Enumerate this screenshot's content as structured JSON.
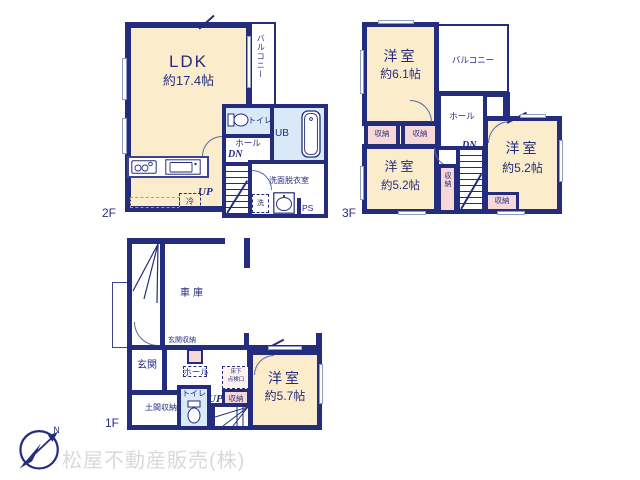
{
  "watermark": "松屋不動産販売(株)",
  "compass": {
    "north_label": "N"
  },
  "floor_labels": {
    "f1": "1F",
    "f2": "2F",
    "f3": "3F"
  },
  "terms": {
    "balcony": "バルコニー",
    "hall": "ホール",
    "toilet": "トイレ",
    "closet": "収納",
    "dn": "DN",
    "up": "UP",
    "unit_bath": "UB",
    "washroom": "洗面脱衣室",
    "washer": "洗",
    "pipe_space": "PS",
    "fridge": "冷",
    "garage": "車庫",
    "entrance": "玄関",
    "entrance_storage": "玄関収納",
    "doma_storage": "土間収納",
    "underfloor_hatch_line1": "床下",
    "underfloor_hatch_line2": "点検口"
  },
  "rooms": {
    "ldk": {
      "name": "LDK",
      "size": "約17.4帖"
    },
    "f3_room_61": {
      "name": "洋室",
      "size": "約6.1帖"
    },
    "f3_room_52_left": {
      "name": "洋室",
      "size": "約5.2帖"
    },
    "f3_room_52_right": {
      "name": "洋室",
      "size": "約5.2帖"
    },
    "f1_room_57": {
      "name": "洋室",
      "size": "約5.7帖"
    }
  },
  "colors": {
    "wall": "#242d7d",
    "room_cream": "#fbeccb",
    "closet_pink": "#f8d8d7",
    "wet_blue": "#d9e9f8",
    "watermark_gray": "#d9d9d9"
  }
}
